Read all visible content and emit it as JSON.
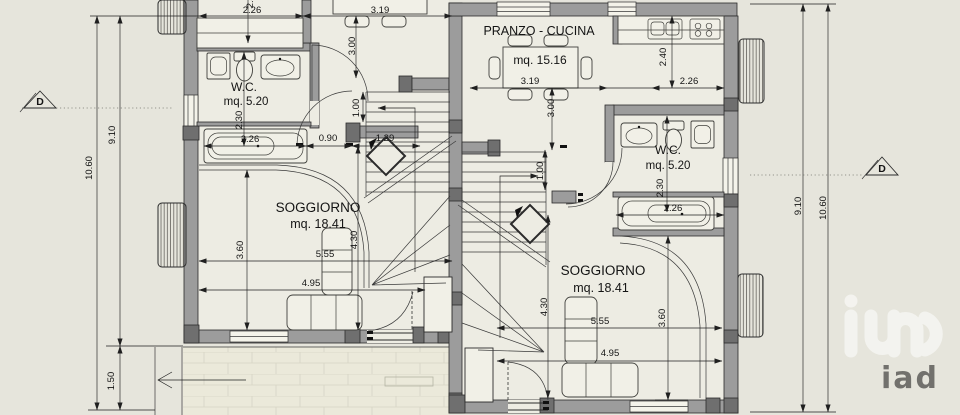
{
  "colors": {
    "background": "#e6e5dc",
    "floor": "#edece3",
    "wall": "#9c9c9c",
    "pilaster": "#6f6f6f",
    "line": "#2b2b2b",
    "logo": "#ffffff"
  },
  "left_unit": {
    "wc": {
      "name": "W.C.",
      "area": "mq. 5.20"
    },
    "soggiorno": {
      "name": "SOGGIORNO",
      "area": "mq. 18.41"
    },
    "dims": {
      "kitchen_width": "2.26",
      "kitchen_depth": "2.40",
      "table_width": "3.19",
      "table_depth": "3.00",
      "hall_height": "1.00",
      "bath_width": "2.26",
      "hall_width": "0.90",
      "stair_opening": "1.29",
      "wc_depth": "2.30",
      "sogg_depth": "3.60",
      "sogg_width_a": "5.55",
      "sogg_width_b": "4.95",
      "sogg_height": "4.30"
    },
    "side_dims": {
      "inner": "9.10",
      "outer": "10.60",
      "path": "1.50"
    },
    "section_marker": "D"
  },
  "right_unit": {
    "pranzo_cucina": {
      "name": "PRANZO - CUCINA",
      "area": "mq. 15.16"
    },
    "wc": {
      "name": "W.C.",
      "area": "mq. 5.20"
    },
    "soggiorno": {
      "name": "SOGGIORNO",
      "area": "mq. 18.41"
    },
    "dims": {
      "table_width": "3.19",
      "kitchen_width": "2.26",
      "kitchen_depth": "2.40",
      "table_depth": "3.00",
      "hall_height": "1.00",
      "wc_depth": "2.30",
      "bath_width": "2.26",
      "sogg_height": "4.30",
      "sogg_width_a": "5.55",
      "sogg_width_b": "4.95",
      "sogg_depth": "3.60"
    },
    "side_dims": {
      "inner": "9.10",
      "outer": "10.60"
    },
    "section_marker": "D"
  },
  "logo": {
    "text": "iad"
  }
}
